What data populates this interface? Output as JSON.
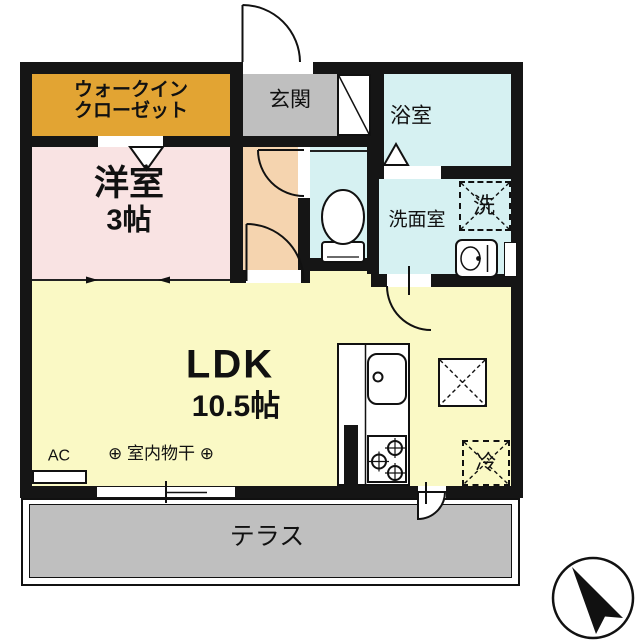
{
  "rooms": {
    "walk_in_closet": {
      "line1": "ウォークイン",
      "line2": "クローゼット"
    },
    "entrance": {
      "label": "玄関"
    },
    "bathroom": {
      "label": "浴室"
    },
    "western_room": {
      "label": "洋室",
      "size": "3帖"
    },
    "washroom": {
      "label": "洗面室"
    },
    "ldk": {
      "label": "LDK",
      "size": "10.5帖"
    },
    "terrace": {
      "label": "テラス"
    }
  },
  "fixtures": {
    "washer": "洗",
    "fridge": "冷",
    "air_conditioner": "AC",
    "indoor_drying": "⊕ 室内物干 ⊕"
  },
  "colors": {
    "walk_in_closet": "#E2A433",
    "entrance_floor": "#BFBFBF",
    "western_room": "#F9E3E3",
    "hallway": "#F5D4AF",
    "wet_rooms": "#D6F1F2",
    "ldk": "#FAF9C5",
    "terrace": "#BFBFBF",
    "walls": "#151515"
  }
}
